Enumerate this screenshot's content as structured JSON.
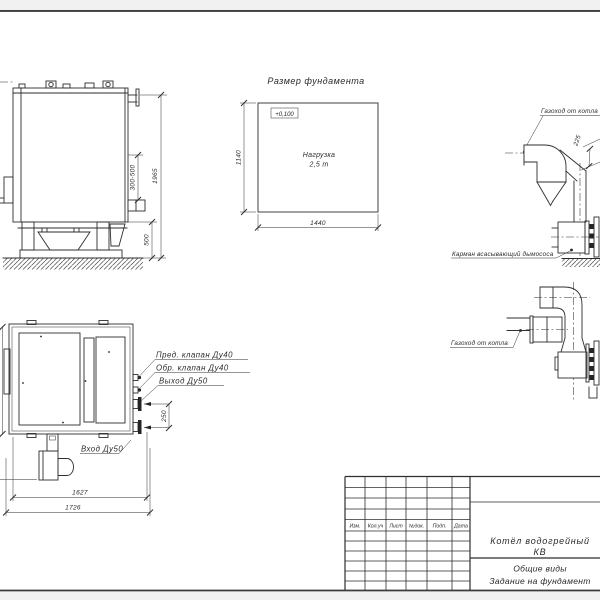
{
  "drawing": {
    "side_view": {
      "dim_height_range": "300-500",
      "dim_total_height": "1965",
      "dim_base_height": "500"
    },
    "foundation": {
      "title": "Размер фундамента",
      "elevation": "+0,100",
      "load_line1": "Нагрузка",
      "load_line2": "2,5 т",
      "dim_depth": "1140",
      "dim_width": "1440"
    },
    "flue_upper": {
      "flue_label": "Газоход от котла",
      "pocket_label": "Карман всасывающий дымососа",
      "dim_duct": "225"
    },
    "flue_lower": {
      "flue_label": "Газоход от котла"
    },
    "top_view": {
      "label_safety_valve": "Пред. клапан Ду40",
      "label_check_valve": "Обр. клапан Ду40",
      "label_outlet": "Выход Ду50",
      "label_inlet": "Вход Ду50",
      "dim_ports": "250",
      "dim_body_length": "1627",
      "dim_total_length": "1726"
    },
    "title_block": {
      "columns": [
        "Изм.",
        "Кол.уч",
        "Лист",
        "№док.",
        "Подп.",
        "Дата"
      ],
      "product_line1": "Котёл водогрейный",
      "product_line2": "КВ",
      "doc_line1": "Общие виды",
      "doc_line2": "Задание на фундамент"
    }
  }
}
